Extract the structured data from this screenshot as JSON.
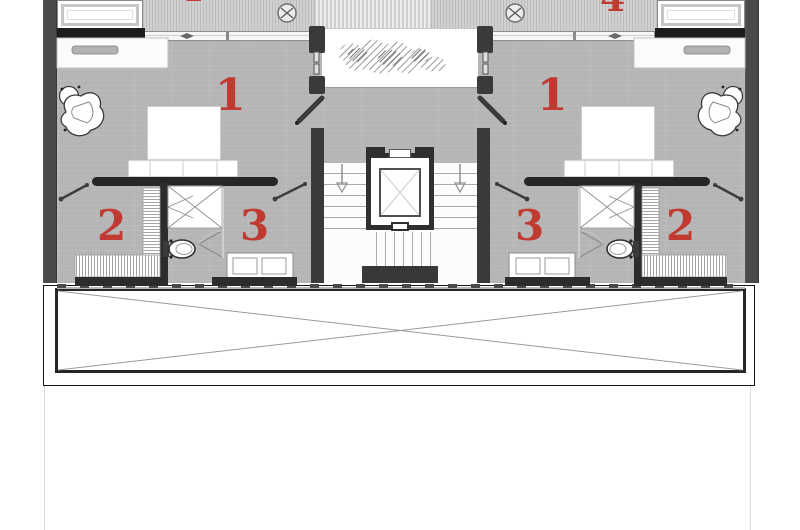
{
  "labels": {
    "bedroom_left": "1",
    "bedroom_right": "1",
    "closet_left": "2",
    "closet_right": "2",
    "bath_left": "3",
    "bath_right": "3",
    "upper_left": "4",
    "upper_right": "4"
  },
  "colors": {
    "label_red": "#c03a31",
    "floor_gray": "#b5b5b5",
    "wall_dark": "#3a3a3a",
    "wall_black": "#262626"
  }
}
